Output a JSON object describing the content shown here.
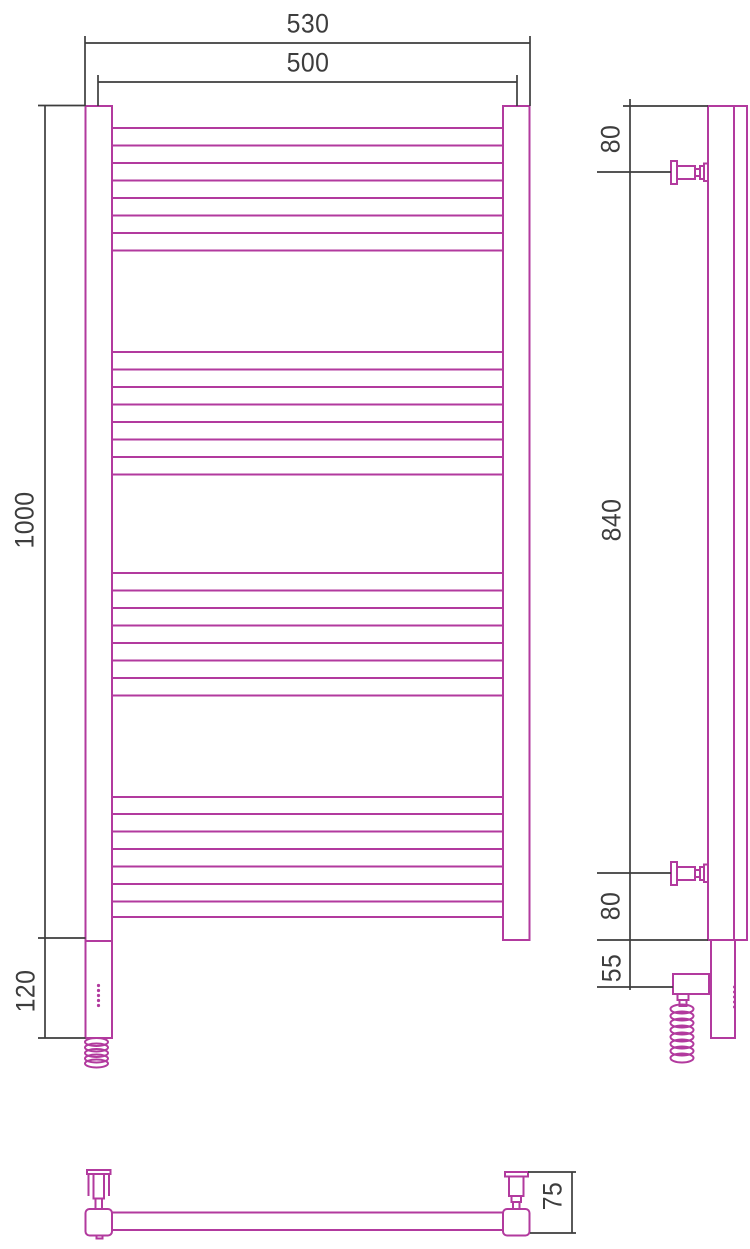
{
  "title": "Heated towel rail technical drawing",
  "colors": {
    "product": "#b23a9e",
    "dimension": "#3d3d3d",
    "background": "#ffffff"
  },
  "dims": {
    "front_overall_width": {
      "label": "530"
    },
    "front_rail_width": {
      "label": "500"
    },
    "front_height": {
      "label": "1000"
    },
    "front_heater_section": {
      "label": "120"
    },
    "side_top_bracket_offset": {
      "label": "80"
    },
    "side_bracket_span": {
      "label": "840"
    },
    "side_bottom_bracket_offset": {
      "label": "80"
    },
    "side_heater_offset": {
      "label": "55"
    },
    "bottom_depth": {
      "label": "75"
    }
  },
  "drawing": {
    "stroke": {
      "product_width": 2,
      "dimension_width": 1.7
    },
    "product": {
      "rails": {
        "x1": 112,
        "x2": 503,
        "groups": [
          [
            128,
            145.5,
            163,
            180.5,
            198,
            215.5,
            233,
            250.5
          ],
          [
            352,
            369.5,
            387,
            404.5,
            422,
            439.5,
            457,
            474.5
          ],
          [
            573,
            590.5,
            608,
            625.5,
            643,
            660.5,
            678,
            695.5
          ],
          [
            797,
            814,
            831.5,
            849,
            866.5,
            884,
            901.5,
            917
          ]
        ]
      },
      "lines": [
        [
          734,
          106,
          734,
          940
        ],
        [
          112,
          1212.5,
          503,
          1212.5
        ],
        [
          112,
          1230,
          503,
          1230
        ],
        [
          88.5,
          1174,
          88.5,
          1196
        ],
        [
          109,
          1174,
          109,
          1196
        ]
      ],
      "rects": [
        [
          85.5,
          106,
          26.5,
          835,
          0
        ],
        [
          85.5,
          941,
          26.5,
          97,
          0
        ],
        [
          503,
          106,
          26.5,
          834,
          0
        ],
        [
          708,
          106,
          39,
          834,
          0
        ],
        [
          711,
          940,
          24,
          98,
          0
        ],
        [
          673,
          974,
          36,
          20,
          0
        ],
        [
          677.5,
          994,
          11,
          6,
          0
        ],
        [
          679.5,
          1000,
          7,
          6,
          0
        ],
        [
          671,
          161,
          6,
          23,
          0
        ],
        [
          677,
          166,
          18,
          13,
          0
        ],
        [
          695,
          169,
          5,
          7,
          0
        ],
        [
          700,
          166,
          4,
          13,
          0
        ],
        [
          704,
          163.5,
          4,
          17.5,
          0
        ],
        [
          671,
          862,
          6,
          23,
          0
        ],
        [
          677,
          867,
          18,
          13,
          0
        ],
        [
          695,
          870,
          5,
          7,
          0
        ],
        [
          700,
          867,
          4,
          13,
          0
        ],
        [
          704,
          864.5,
          4,
          17.5,
          0
        ],
        [
          85.5,
          1209,
          26.5,
          26.5,
          4
        ],
        [
          503,
          1209,
          26.5,
          26.5,
          4
        ],
        [
          87,
          1170,
          23.5,
          4,
          0
        ],
        [
          93.5,
          1174,
          10.5,
          24.5,
          0
        ],
        [
          95.5,
          1198.5,
          6.5,
          10.5,
          0
        ],
        [
          96.5,
          1235.5,
          6,
          3,
          0
        ],
        [
          505,
          1172,
          23,
          4.5,
          0
        ],
        [
          509,
          1176.5,
          14.5,
          19.5,
          0
        ],
        [
          511.5,
          1196,
          9.5,
          6,
          0
        ],
        [
          513,
          1202,
          6.5,
          7,
          0
        ]
      ],
      "ellipses": [
        [
          96.5,
          1042,
          11.5,
          4
        ],
        [
          96.5,
          1047.5,
          11.5,
          4
        ],
        [
          96.5,
          1053,
          11.5,
          4
        ],
        [
          96.5,
          1058.5,
          11.5,
          4
        ],
        [
          96.5,
          1063.5,
          11.5,
          4
        ],
        [
          682,
          1009,
          11.5,
          4.5
        ],
        [
          682,
          1016,
          11.5,
          4.5
        ],
        [
          682,
          1023,
          11.5,
          4.5
        ],
        [
          682,
          1030,
          11.5,
          4.5
        ],
        [
          682,
          1037,
          11.5,
          4.5
        ],
        [
          682,
          1044,
          11.5,
          4.5
        ],
        [
          682,
          1051,
          11.5,
          4.5
        ],
        [
          682,
          1058,
          11.5,
          4.5
        ]
      ],
      "dots": [
        [
          98.5,
          985.5,
          1.6
        ],
        [
          98.5,
          990.5,
          1.6
        ],
        [
          98.5,
          995.5,
          1.6
        ],
        [
          98.5,
          1000.5,
          1.6
        ],
        [
          98.5,
          1005.5,
          1.6
        ],
        [
          734.5,
          987,
          1.5
        ],
        [
          734.5,
          992,
          1.5
        ],
        [
          734.5,
          997,
          1.5
        ],
        [
          734.5,
          1002,
          1.5
        ],
        [
          734.5,
          1007,
          1.5
        ]
      ]
    },
    "dimension": {
      "lines": [
        [
          85,
          43,
          530,
          43
        ],
        [
          85,
          36,
          85,
          106
        ],
        [
          530,
          36,
          530,
          106
        ],
        [
          98,
          82,
          517,
          82
        ],
        [
          98,
          75,
          98,
          106
        ],
        [
          517,
          75,
          517,
          106
        ],
        [
          45,
          106,
          45,
          1038
        ],
        [
          38,
          105.5,
          85.5,
          105.5
        ],
        [
          38,
          938,
          85.5,
          938
        ],
        [
          38,
          1038,
          85.5,
          1038
        ],
        [
          630,
          99,
          630,
          990
        ],
        [
          623,
          106,
          708,
          106
        ],
        [
          597,
          172,
          671,
          172
        ],
        [
          597,
          873,
          671,
          873
        ],
        [
          597,
          940,
          708,
          940
        ],
        [
          597,
          987,
          673,
          987
        ],
        [
          528,
          1172,
          576,
          1172
        ],
        [
          572,
          1172,
          572,
          1233
        ],
        [
          530,
          1233,
          576,
          1233
        ]
      ]
    }
  }
}
